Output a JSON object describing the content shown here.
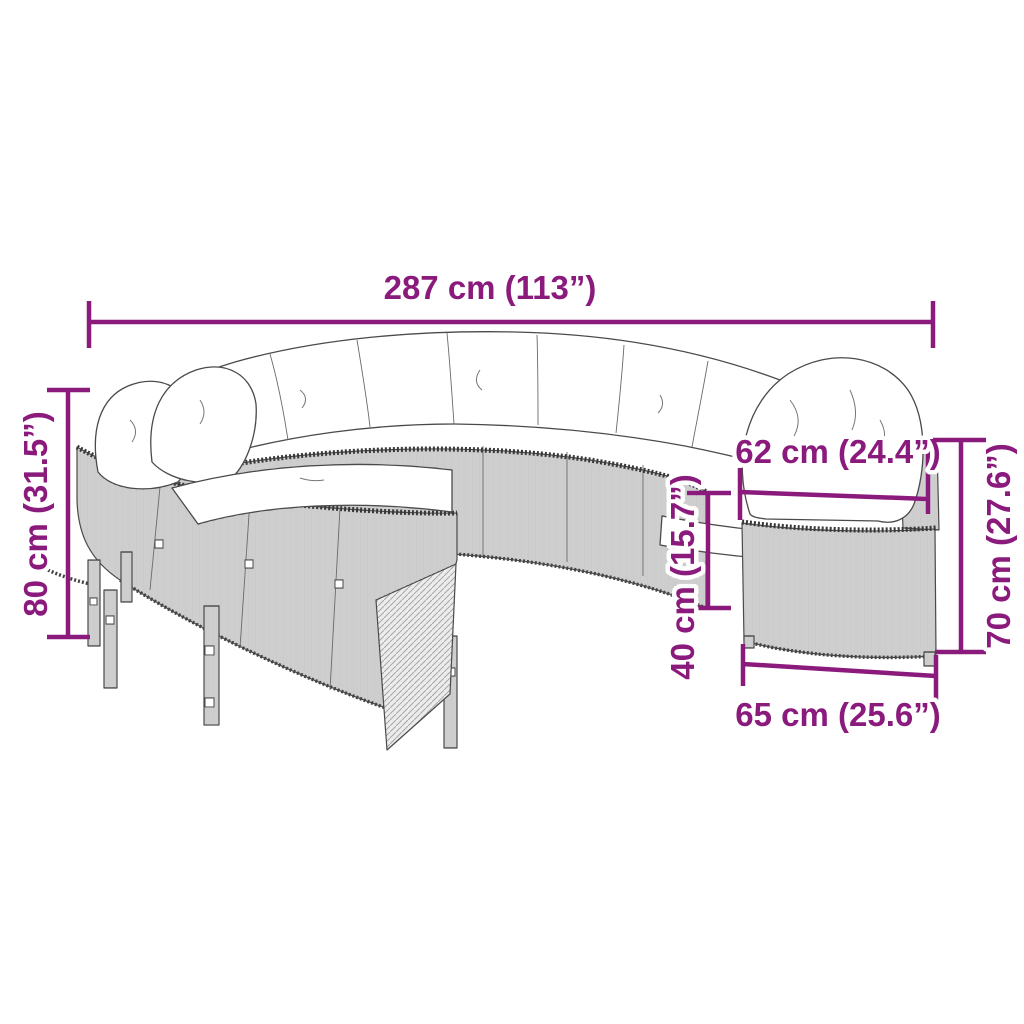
{
  "diagram": {
    "type": "product-dimension-diagram",
    "subject": "round poly rattan outdoor sofa set with cushions",
    "accent_color": "#8b1a7d",
    "line_color": "#4a4a4a",
    "dimensions": {
      "overall_width": {
        "label": "287 cm (113”)",
        "cm": 287,
        "inches": 113
      },
      "overall_height": {
        "label": "80 cm (31.5”)",
        "cm": 80,
        "inches": 31.5
      },
      "seat_width": {
        "label": "62 cm (24.4”)",
        "cm": 62,
        "inches": 24.4
      },
      "seat_height": {
        "label": "40 cm (15.7”)",
        "cm": 40,
        "inches": 15.7
      },
      "side_height": {
        "label": "70 cm (27.6”)",
        "cm": 70,
        "inches": 27.6
      },
      "side_depth": {
        "label": "65 cm (25.6”)",
        "cm": 65,
        "inches": 25.6
      }
    }
  }
}
